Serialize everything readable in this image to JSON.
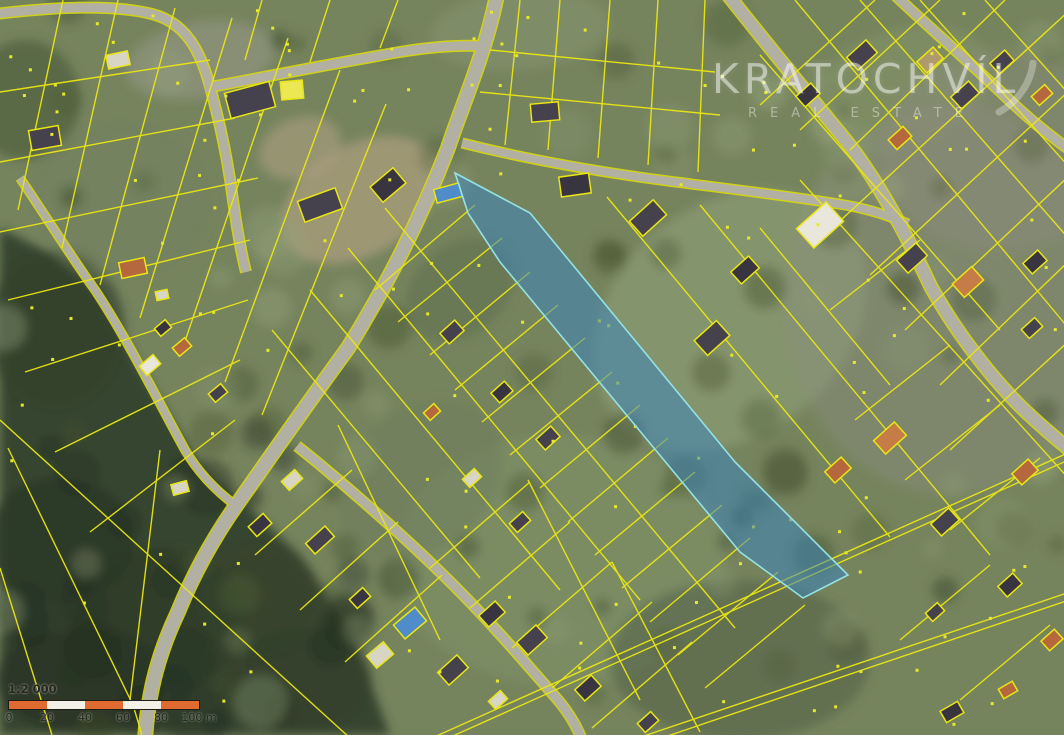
{
  "watermark": {
    "title": "KRATOCHVÍL",
    "subtitle": "REAL ESTATE",
    "text_color": "#ffffff"
  },
  "scalebar": {
    "ratio_label": "1:2 000",
    "tick_labels": [
      "0",
      "20",
      "40",
      "60",
      "80",
      "100 m"
    ],
    "segment_px": 38,
    "segment_color_a": "#e06a30",
    "segment_color_b": "#f3f0e7",
    "border_color": "#1d1d18",
    "text_color": "#26261f"
  },
  "map": {
    "size": [
      1064,
      735
    ],
    "palette": {
      "base": "#76845e",
      "road": "#b2b0a3",
      "road_edge": "#d9d90e",
      "parcel_line": "#eae614",
      "forest": "#323f2b",
      "highlight_fill": "rgba(58,132,190,0.52)",
      "highlight_stroke": "#93e2e6",
      "dot": "#e6e82a"
    },
    "highlight_parcel": {
      "points": [
        [
          455,
          173
        ],
        [
          530,
          213
        ],
        [
          735,
          462
        ],
        [
          848,
          575
        ],
        [
          803,
          598
        ],
        [
          740,
          552
        ],
        [
          500,
          262
        ],
        [
          468,
          213
        ]
      ]
    },
    "forest_polygon": [
      [
        0,
        228
      ],
      [
        60,
        258
      ],
      [
        100,
        295
      ],
      [
        150,
        385
      ],
      [
        200,
        465
      ],
      [
        240,
        500
      ],
      [
        300,
        555
      ],
      [
        355,
        640
      ],
      [
        390,
        735
      ],
      [
        0,
        735
      ]
    ],
    "patches": [
      [
        60,
        540,
        75,
        62,
        0,
        "#2a3625",
        0.75
      ],
      [
        160,
        620,
        85,
        72,
        0,
        "#2e3b28",
        0.75
      ],
      [
        80,
        680,
        85,
        52,
        0,
        "#283423",
        0.75
      ],
      [
        260,
        600,
        62,
        56,
        0,
        "#37442c",
        0.6
      ],
      [
        300,
        680,
        72,
        52,
        0,
        "#32402a",
        0.6
      ],
      [
        55,
        330,
        70,
        80,
        0,
        "#35422c",
        0.7
      ],
      [
        25,
        100,
        55,
        60,
        0,
        "#4a5839",
        0.6
      ],
      [
        360,
        200,
        85,
        55,
        -30,
        "#a59a78",
        0.85
      ],
      [
        300,
        148,
        42,
        30,
        -20,
        "#ad9f80",
        0.6
      ],
      [
        730,
        320,
        150,
        115,
        -40,
        "#8a9a72",
        0.75
      ],
      [
        560,
        560,
        165,
        125,
        0,
        "#7f9168",
        0.6
      ],
      [
        900,
        90,
        95,
        60,
        -20,
        "#849468",
        0.55
      ],
      [
        950,
        300,
        165,
        195,
        0,
        "#8d8b80",
        0.4
      ],
      [
        1000,
        150,
        120,
        100,
        0,
        "#8f8d82",
        0.35
      ],
      [
        200,
        60,
        75,
        38,
        -10,
        "#9a9a8c",
        0.5
      ],
      [
        520,
        30,
        90,
        40,
        -5,
        "#879372",
        0.5
      ],
      [
        420,
        480,
        90,
        70,
        -40,
        "#6d7d5c",
        0.5
      ],
      [
        120,
        200,
        90,
        80,
        0,
        "#6f7f60",
        0.5
      ],
      [
        740,
        660,
        130,
        80,
        0,
        "#55634a",
        0.6
      ],
      [
        460,
        290,
        60,
        45,
        -40,
        "#5f6f50",
        0.55
      ]
    ],
    "roads": [
      {
        "d": "M497,-5 C485,55 462,105 448,148 C420,220 388,283 348,348 C310,400 275,450 240,500 C215,535 195,570 178,612 C160,650 148,690 145,740",
        "w": 13
      },
      {
        "d": "M-5,14 C55,7 112,4 152,14 C192,24 204,62 213,98 C221,128 228,162 233,200 C236,222 240,248 246,272",
        "w": 9
      },
      {
        "d": "M205,88 C260,78 330,64 400,52 C430,47 460,45 482,46",
        "w": 9
      },
      {
        "d": "M728,-5 C762,38 806,92 843,137 C872,172 902,225 931,287 C956,332 990,376 1022,408 C1040,425 1055,438 1070,450",
        "w": 12
      },
      {
        "d": "M895,-5 C923,22 965,58 1006,97 C1030,120 1050,136 1070,150",
        "w": 9
      },
      {
        "d": "M462,143 C530,160 600,172 668,181 C730,189 790,196 845,205 C868,209 890,216 908,224",
        "w": 8
      },
      {
        "d": "M297,446 C330,472 395,528 438,570 C480,610 525,662 558,700 C568,712 576,724 582,740",
        "w": 9
      },
      {
        "d": "M20,178 C45,215 70,255 95,290 C125,335 155,395 185,450 C198,472 215,490 235,505",
        "w": 7
      }
    ],
    "parcel_lines": [
      [
        63,
        0,
        18,
        210
      ],
      [
        118,
        0,
        62,
        248
      ],
      [
        175,
        8,
        100,
        285
      ],
      [
        232,
        18,
        140,
        318
      ],
      [
        288,
        38,
        182,
        350
      ],
      [
        340,
        70,
        225,
        382
      ],
      [
        386,
        104,
        262,
        415
      ],
      [
        0,
        92,
        210,
        60
      ],
      [
        0,
        162,
        235,
        118
      ],
      [
        0,
        232,
        258,
        178
      ],
      [
        8,
        300,
        250,
        240
      ],
      [
        25,
        372,
        248,
        300
      ],
      [
        55,
        452,
        240,
        360
      ],
      [
        0,
        420,
        350,
        738
      ],
      [
        90,
        532,
        235,
        420
      ],
      [
        8,
        448,
        133,
        705
      ],
      [
        160,
        450,
        130,
        700
      ],
      [
        133,
        705,
        142,
        735
      ],
      [
        0,
        568,
        52,
        735
      ],
      [
        262,
        0,
        245,
        60
      ],
      [
        330,
        0,
        310,
        62
      ],
      [
        398,
        0,
        380,
        48
      ],
      [
        520,
        0,
        505,
        145
      ],
      [
        560,
        0,
        548,
        150
      ],
      [
        610,
        0,
        598,
        158
      ],
      [
        658,
        0,
        648,
        165
      ],
      [
        705,
        0,
        698,
        172
      ],
      [
        480,
        92,
        720,
        115
      ],
      [
        490,
        50,
        715,
        72
      ],
      [
        385,
        208,
        735,
        628
      ],
      [
        348,
        248,
        640,
        600
      ],
      [
        310,
        290,
        560,
        590
      ],
      [
        272,
        330,
        480,
        578
      ],
      [
        475,
        205,
        375,
        290
      ],
      [
        502,
        238,
        398,
        322
      ],
      [
        530,
        272,
        430,
        355
      ],
      [
        558,
        305,
        455,
        390
      ],
      [
        585,
        338,
        482,
        422
      ],
      [
        612,
        372,
        510,
        455
      ],
      [
        640,
        405,
        540,
        488
      ],
      [
        668,
        438,
        568,
        522
      ],
      [
        695,
        472,
        595,
        555
      ],
      [
        722,
        505,
        622,
        588
      ],
      [
        750,
        538,
        650,
        622
      ],
      [
        778,
        572,
        678,
        655
      ],
      [
        805,
        605,
        705,
        688
      ],
      [
        607,
        197,
        890,
        537
      ],
      [
        700,
        205,
        990,
        555
      ],
      [
        855,
        420,
        950,
        345
      ],
      [
        905,
        480,
        1000,
        405
      ],
      [
        950,
        530,
        1040,
        458
      ],
      [
        760,
        228,
        890,
        385
      ],
      [
        830,
        310,
        920,
        240
      ],
      [
        795,
        0,
        1070,
        330
      ],
      [
        860,
        0,
        1070,
        240
      ],
      [
        920,
        0,
        1070,
        168
      ],
      [
        985,
        0,
        1070,
        95
      ],
      [
        760,
        55,
        1000,
        330
      ],
      [
        800,
        180,
        1070,
        480
      ],
      [
        1070,
        10,
        830,
        230
      ],
      [
        1070,
        90,
        870,
        275
      ],
      [
        1070,
        175,
        905,
        330
      ],
      [
        1070,
        260,
        940,
        385
      ],
      [
        1005,
        0,
        850,
        150
      ],
      [
        940,
        0,
        800,
        130
      ],
      [
        875,
        0,
        760,
        105
      ],
      [
        1070,
        340,
        950,
        450
      ],
      [
        430,
        568,
        530,
        482
      ],
      [
        470,
        608,
        570,
        522
      ],
      [
        512,
        648,
        612,
        562
      ],
      [
        552,
        688,
        652,
        602
      ],
      [
        592,
        728,
        692,
        642
      ],
      [
        528,
        480,
        640,
        700
      ],
      [
        612,
        562,
        700,
        732
      ],
      [
        338,
        425,
        440,
        640
      ],
      [
        255,
        555,
        352,
        470
      ],
      [
        300,
        610,
        398,
        522
      ],
      [
        345,
        662,
        442,
        575
      ],
      [
        432,
        738,
        1070,
        452
      ],
      [
        435,
        744,
        1073,
        458
      ],
      [
        638,
        738,
        1070,
        592
      ],
      [
        641,
        745,
        1072,
        599
      ],
      [
        900,
        640,
        990,
        565
      ],
      [
        960,
        700,
        1050,
        625
      ]
    ],
    "building_colors": {
      "d": "#45424d",
      "e": "#383540",
      "o": "#b5673d",
      "p": "#c67c46",
      "l": "#d8d5c5",
      "w": "#e9e7dc",
      "t": "#b09a6c",
      "y": "#ece853",
      "b": "#4f8cc9"
    },
    "buildings": [
      [
        45,
        138,
        30,
        20,
        -10,
        "d"
      ],
      [
        118,
        60,
        22,
        14,
        -12,
        "l"
      ],
      [
        250,
        100,
        46,
        26,
        -15,
        "d"
      ],
      [
        292,
        90,
        22,
        18,
        -5,
        "y"
      ],
      [
        320,
        205,
        40,
        22,
        -20,
        "d"
      ],
      [
        388,
        185,
        30,
        20,
        -40,
        "e"
      ],
      [
        133,
        268,
        26,
        16,
        -12,
        "o"
      ],
      [
        162,
        295,
        12,
        9,
        -12,
        "l"
      ],
      [
        182,
        347,
        16,
        11,
        -40,
        "o"
      ],
      [
        150,
        365,
        18,
        12,
        -40,
        "w"
      ],
      [
        163,
        328,
        14,
        10,
        -40,
        "e"
      ],
      [
        218,
        393,
        16,
        11,
        -40,
        "d"
      ],
      [
        180,
        488,
        16,
        11,
        -15,
        "l"
      ],
      [
        292,
        480,
        18,
        12,
        -42,
        "l"
      ],
      [
        320,
        540,
        26,
        14,
        -42,
        "d"
      ],
      [
        260,
        525,
        20,
        13,
        -42,
        "e"
      ],
      [
        545,
        112,
        28,
        18,
        -5,
        "d"
      ],
      [
        575,
        185,
        30,
        20,
        -8,
        "e"
      ],
      [
        648,
        218,
        32,
        20,
        -42,
        "d"
      ],
      [
        712,
        338,
        30,
        20,
        -42,
        "d"
      ],
      [
        745,
        270,
        24,
        16,
        -42,
        "e"
      ],
      [
        820,
        225,
        40,
        26,
        -42,
        "w"
      ],
      [
        862,
        55,
        26,
        17,
        -42,
        "d"
      ],
      [
        808,
        95,
        20,
        14,
        -42,
        "e"
      ],
      [
        930,
        60,
        22,
        15,
        -42,
        "t"
      ],
      [
        965,
        95,
        24,
        16,
        -42,
        "d"
      ],
      [
        900,
        138,
        20,
        13,
        -42,
        "o"
      ],
      [
        1002,
        62,
        20,
        14,
        -42,
        "d"
      ],
      [
        1042,
        95,
        18,
        12,
        -42,
        "o"
      ],
      [
        912,
        258,
        26,
        17,
        -42,
        "d"
      ],
      [
        968,
        282,
        26,
        18,
        -42,
        "p"
      ],
      [
        1035,
        262,
        20,
        14,
        -42,
        "e"
      ],
      [
        1032,
        328,
        18,
        12,
        -42,
        "d"
      ],
      [
        890,
        438,
        28,
        18,
        -42,
        "p"
      ],
      [
        838,
        470,
        22,
        15,
        -42,
        "o"
      ],
      [
        945,
        522,
        24,
        16,
        -42,
        "d"
      ],
      [
        1025,
        472,
        22,
        15,
        -42,
        "o"
      ],
      [
        1010,
        585,
        20,
        14,
        -42,
        "e"
      ],
      [
        1052,
        640,
        18,
        13,
        -42,
        "o"
      ],
      [
        935,
        612,
        16,
        11,
        -42,
        "d"
      ],
      [
        452,
        332,
        20,
        14,
        -42,
        "d"
      ],
      [
        502,
        392,
        18,
        13,
        -42,
        "e"
      ],
      [
        548,
        438,
        20,
        14,
        -42,
        "d"
      ],
      [
        472,
        478,
        16,
        11,
        -42,
        "l"
      ],
      [
        520,
        522,
        18,
        12,
        -42,
        "d"
      ],
      [
        432,
        412,
        14,
        10,
        -42,
        "o"
      ],
      [
        410,
        623,
        28,
        18,
        -40,
        "b"
      ],
      [
        448,
        193,
        26,
        14,
        -15,
        "b"
      ],
      [
        380,
        655,
        22,
        16,
        -40,
        "l"
      ],
      [
        360,
        598,
        18,
        12,
        -42,
        "e"
      ],
      [
        453,
        670,
        26,
        17,
        -42,
        "d"
      ],
      [
        492,
        614,
        22,
        15,
        -42,
        "e"
      ],
      [
        532,
        640,
        26,
        17,
        -42,
        "d"
      ],
      [
        588,
        688,
        22,
        15,
        -42,
        "e"
      ],
      [
        648,
        722,
        18,
        12,
        -42,
        "d"
      ],
      [
        498,
        700,
        16,
        11,
        -42,
        "l"
      ],
      [
        952,
        712,
        20,
        13,
        -30,
        "e"
      ],
      [
        1008,
        690,
        16,
        11,
        -30,
        "o"
      ]
    ],
    "texture": {
      "seed": 9,
      "dots": 150,
      "dark_blobs": 70,
      "forest_blobs": 26,
      "light_blobs": 42,
      "dark_colors": [
        "#46542f",
        "#3c4a2c",
        "#525f38"
      ],
      "light_colors": [
        "#95a37c",
        "#8b9a74"
      ]
    }
  }
}
